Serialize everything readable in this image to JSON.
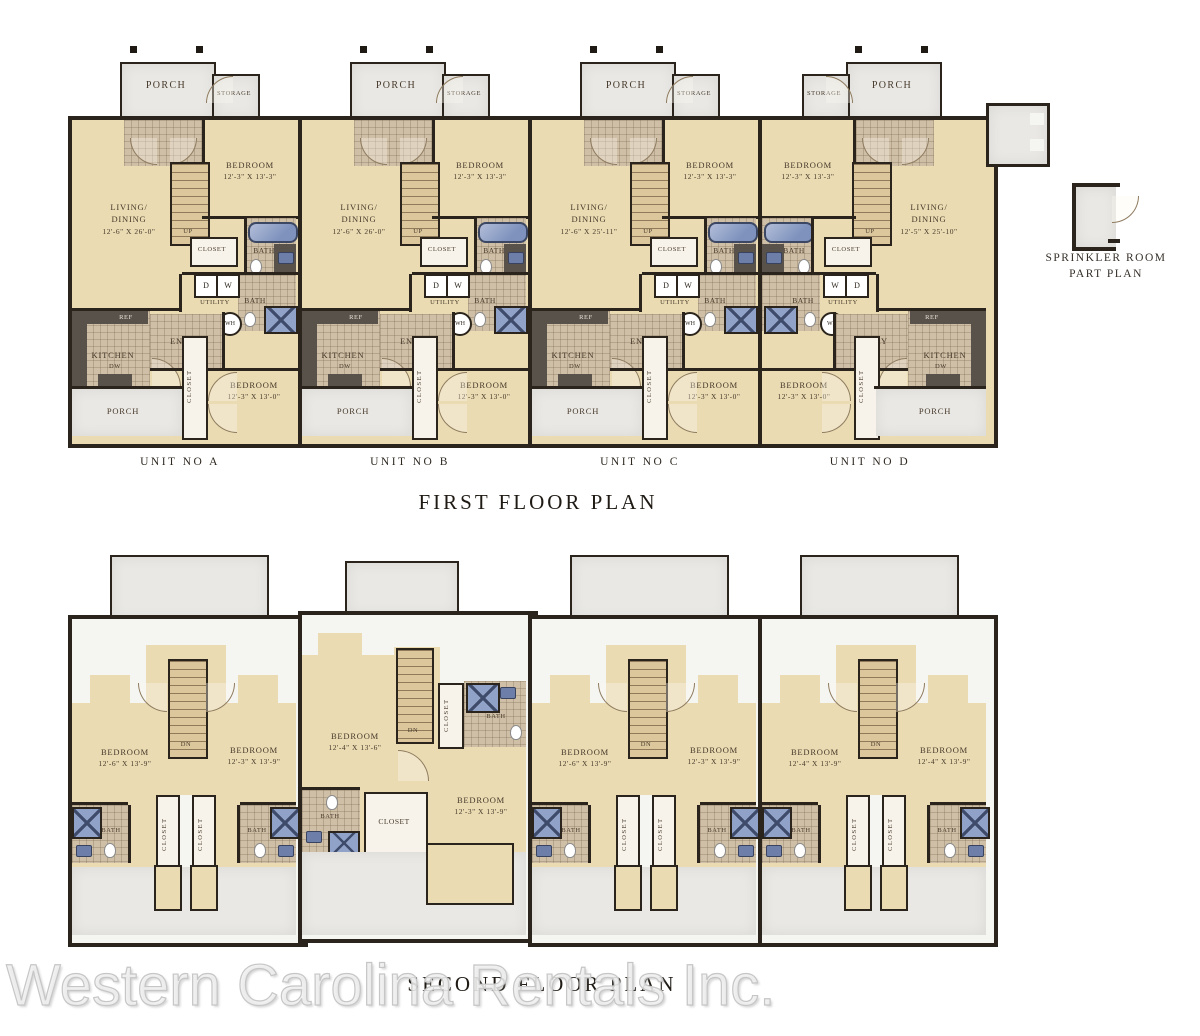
{
  "labels": {
    "porch": "PORCH",
    "storage": "STORAGE",
    "up": "UP",
    "dn": "DN",
    "closet": "CLOSET",
    "bath": "BATH",
    "utility": "UTILITY",
    "dryer": "D",
    "washer": "W",
    "ac": "AC",
    "wh": "WH",
    "ref": "REF",
    "kitchen": "KITCHEN",
    "entry": "ENTRY",
    "dw": "DW",
    "bedroom": "BEDROOM",
    "living1": "LIVING/",
    "living2": "DINING"
  },
  "first_floor": {
    "title": "FIRST FLOOR PLAN",
    "units": [
      {
        "name": "UNIT NO A",
        "living_dim": "12'-6\" X 26'-0\"",
        "bed1_dim": "12'-3\" X 13'-3\"",
        "bed2_dim": "12'-3\" X 13'-0\""
      },
      {
        "name": "UNIT NO B",
        "living_dim": "12'-6\" X 26'-0\"",
        "bed1_dim": "12'-3\" X 13'-3\"",
        "bed2_dim": "12'-3\" X 13'-0\""
      },
      {
        "name": "UNIT NO C",
        "living_dim": "12'-6\" X 25'-11\"",
        "bed1_dim": "12'-3\" X 13'-3\"",
        "bed2_dim": "12'-3\" X 13'-0\""
      },
      {
        "name": "UNIT NO D",
        "living_dim": "12'-5\" X 25'-10\"",
        "bed1_dim": "12'-3\" X 13'-3\"",
        "bed2_dim": "12'-3\" X 13'-0\""
      }
    ]
  },
  "second_floor": {
    "title": "SECOND FLOOR PLAN",
    "units": [
      {
        "bed_left_dim": "12'-6\" X 13'-9\"",
        "bed_right_dim": "12'-3\" X 13'-9\""
      },
      {
        "bed_left_dim": "12'-4\" X 13'-6\"",
        "bed_right_dim": "12'-3\" X 13'-9\""
      },
      {
        "bed_left_dim": "12'-6\" X 13'-9\"",
        "bed_right_dim": "12'-3\" X 13'-9\""
      },
      {
        "bed_left_dim": "12'-4\" X 13'-9\"",
        "bed_right_dim": "12'-4\" X 13'-9\""
      }
    ]
  },
  "sprinkler": {
    "line1": "SPRINKLER ROOM",
    "line2": "PART PLAN"
  },
  "watermark": "Western Carolina Rentals Inc.",
  "colors": {
    "wall": "#2b241c",
    "floor": "#eadbb2",
    "porch": "#e9e8e4",
    "fixture_blue": "#91a2c8"
  }
}
